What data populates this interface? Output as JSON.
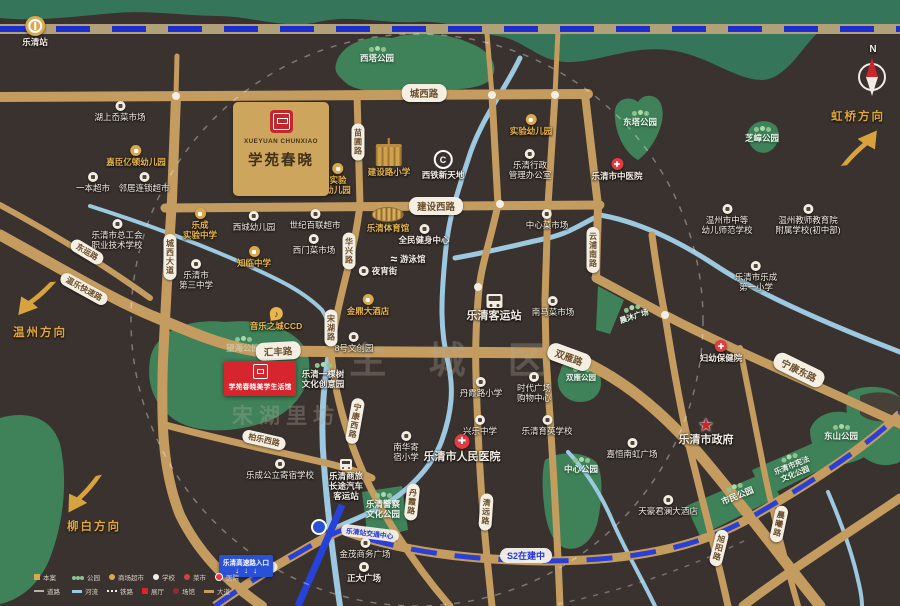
{
  "watermarks": [
    {
      "text": "主 城 区",
      "x": 455,
      "y": 330
    },
    {
      "text": "宋湖里坊",
      "x": 286,
      "y": 400
    }
  ],
  "project": {
    "logo_en": "XUEYUAN CHUNXIAO",
    "logo_cn": "学苑春晓",
    "sales_label": "学苑春晓美学生活馆"
  },
  "compass": {
    "n": "N"
  },
  "labels": {
    "s2": "S2在建中",
    "hub": "乐清站交通中心",
    "highway": "乐清高速路入口",
    "highway_arrows": "↓↓↓"
  },
  "directions": [
    {
      "label": "虹桥方向",
      "x": 858,
      "y": 108
    },
    {
      "label": "温州方向",
      "x": 40,
      "y": 324
    },
    {
      "label": "柳白方向",
      "x": 94,
      "y": 518
    }
  ],
  "road_badges": [
    {
      "label": "城西路",
      "x": 424,
      "y": 93,
      "cls": "lg"
    },
    {
      "label": "建设西路",
      "x": 436,
      "y": 206,
      "cls": "lg"
    },
    {
      "label": "汇丰路",
      "x": 278,
      "y": 351,
      "rot": -3,
      "cls": "lg"
    },
    {
      "label": "双雁路",
      "x": 569,
      "y": 357,
      "rot": 20,
      "cls": "lg"
    },
    {
      "label": "宁康东路",
      "x": 799,
      "y": 370,
      "rot": 26,
      "cls": "lg"
    },
    {
      "label": "温乐快速路",
      "x": 84,
      "y": 289,
      "rot": 29
    },
    {
      "label": "东运路",
      "x": 87,
      "y": 252,
      "rot": 31
    },
    {
      "label": "柏乐西路",
      "x": 264,
      "y": 440,
      "rot": 13
    },
    {
      "label": "城西大道",
      "x": 170,
      "y": 257,
      "cls": "vert"
    },
    {
      "label": "苗圃路",
      "x": 358,
      "y": 142,
      "cls": "vert"
    },
    {
      "label": "华兴路",
      "x": 349,
      "y": 251,
      "cls": "vert"
    },
    {
      "label": "宋湖路",
      "x": 331,
      "y": 328,
      "cls": "vert"
    },
    {
      "label": "宁康西路",
      "x": 355,
      "y": 421,
      "rot": 10,
      "cls": "vert"
    },
    {
      "label": "丹霞路",
      "x": 412,
      "y": 502,
      "rot": 6,
      "cls": "vert"
    },
    {
      "label": "清远路",
      "x": 486,
      "y": 512,
      "rot": 4,
      "cls": "vert"
    },
    {
      "label": "云浦南路",
      "x": 593,
      "y": 250,
      "cls": "vert"
    },
    {
      "label": "旭阳路",
      "x": 719,
      "y": 548,
      "rot": 14,
      "cls": "vert"
    },
    {
      "label": "晨曦路",
      "x": 779,
      "y": 524,
      "rot": 12,
      "cls": "vert"
    }
  ],
  "pois": [
    {
      "x": 35,
      "y": 16,
      "icon": "train",
      "label": "乐清站",
      "cls": "bold"
    },
    {
      "x": 120,
      "y": 101,
      "icon": "w",
      "label": "湖上岙菜市场"
    },
    {
      "x": 136,
      "y": 145,
      "icon": "g",
      "label": "嘉臣亿顿幼儿园",
      "cls": "gold"
    },
    {
      "x": 93,
      "y": 172,
      "icon": "w",
      "label": "一本超市"
    },
    {
      "x": 144,
      "y": 172,
      "icon": "w",
      "label": "邻居连锁超市"
    },
    {
      "x": 377,
      "y": 45,
      "icon": "trees",
      "label": "西塔公园",
      "cls": "park"
    },
    {
      "x": 338,
      "y": 163,
      "icon": "g",
      "label": "实验\n幼儿园",
      "cls": "gold"
    },
    {
      "x": 389,
      "y": 144,
      "icon": "bldg",
      "label": "建设路小学",
      "cls": "gold"
    },
    {
      "x": 443,
      "y": 150,
      "icon": "c",
      "glyph": "C",
      "label": "西铁新天地",
      "cls": "bold"
    },
    {
      "x": 531,
      "y": 114,
      "icon": "g",
      "label": "实验幼儿园",
      "cls": "gold"
    },
    {
      "x": 530,
      "y": 149,
      "icon": "w",
      "label": "乐清行政\n管理办公室"
    },
    {
      "x": 617,
      "y": 158,
      "icon": "h",
      "glyph": "✚",
      "label": "乐清市中医院",
      "cls": "bold"
    },
    {
      "x": 640,
      "y": 109,
      "icon": "trees",
      "label": "东塔公园",
      "cls": "park"
    },
    {
      "x": 762,
      "y": 125,
      "icon": "trees",
      "label": "芝嶂公园",
      "cls": "park"
    },
    {
      "x": 727,
      "y": 204,
      "icon": "w",
      "label": "温州市中等\n幼儿师范学校"
    },
    {
      "x": 808,
      "y": 204,
      "icon": "w",
      "label": "温州教师教育院\n附属学校(初中部)"
    },
    {
      "x": 117,
      "y": 219,
      "icon": "w",
      "label": "乐清市总工会\n职业技术学校"
    },
    {
      "x": 200,
      "y": 208,
      "icon": "g",
      "label": "乐成\n实验中学",
      "cls": "gold"
    },
    {
      "x": 254,
      "y": 211,
      "icon": "w",
      "label": "西城幼儿园"
    },
    {
      "x": 254,
      "y": 246,
      "icon": "g",
      "label": "知临中学",
      "cls": "gold"
    },
    {
      "x": 196,
      "y": 259,
      "icon": "w",
      "label": "乐清市\n第三中学"
    },
    {
      "x": 315,
      "y": 209,
      "icon": "w",
      "label": "世纪百联超市"
    },
    {
      "x": 388,
      "y": 207,
      "icon": "stad",
      "label": "乐清体育馆",
      "cls": "gold"
    },
    {
      "x": 424,
      "y": 224,
      "icon": "w",
      "label": "全民健身中心",
      "cls": "bold"
    },
    {
      "x": 314,
      "y": 234,
      "icon": "w",
      "label": "西门菜市场"
    },
    {
      "x": 408,
      "y": 252,
      "icon": "swim",
      "glyph": "≈",
      "label": "游泳馆",
      "cls": "row bold"
    },
    {
      "x": 378,
      "y": 266,
      "icon": "w",
      "label": "夜宵街",
      "cls": "row bold"
    },
    {
      "x": 547,
      "y": 209,
      "icon": "w",
      "label": "中心菜市场"
    },
    {
      "x": 368,
      "y": 294,
      "icon": "g",
      "label": "金鼎大酒店",
      "cls": "gold"
    },
    {
      "x": 494,
      "y": 294,
      "icon": "bus",
      "label": "乐清客运站",
      "cls": "big"
    },
    {
      "x": 553,
      "y": 296,
      "icon": "w",
      "label": "南马菜市场"
    },
    {
      "x": 756,
      "y": 261,
      "icon": "w",
      "label": "乐清市乐成\n第一小学"
    },
    {
      "x": 276,
      "y": 307,
      "icon": "music",
      "glyph": "♪",
      "label": "音乐之城CCD",
      "cls": "gold"
    },
    {
      "x": 354,
      "y": 332,
      "icon": "w",
      "label": "8号文创园"
    },
    {
      "x": 323,
      "y": 361,
      "icon": "trees",
      "label": "乐清一棵树\n文化创意园",
      "cls": "bold"
    },
    {
      "x": 243,
      "y": 335,
      "icon": "trees",
      "label": "望海公园",
      "cls": "park faint"
    },
    {
      "x": 633,
      "y": 304,
      "icon": "trees",
      "label": "晨沐广场",
      "cls": "park tiny",
      "rot": -18
    },
    {
      "x": 581,
      "y": 365,
      "icon": "trees",
      "label": "双雁公园",
      "cls": "park tiny"
    },
    {
      "x": 406,
      "y": 431,
      "icon": "w",
      "label": "南华寄\n宿小学"
    },
    {
      "x": 462,
      "y": 434,
      "icon": "h",
      "glyph": "✚",
      "label": "乐清市人民医院",
      "cls": "big"
    },
    {
      "x": 480,
      "y": 415,
      "icon": "w",
      "label": "兴乐中学"
    },
    {
      "x": 547,
      "y": 415,
      "icon": "w",
      "label": "乐清育英学校"
    },
    {
      "x": 534,
      "y": 372,
      "icon": "w",
      "label": "时代广场\n购物中心"
    },
    {
      "x": 481,
      "y": 377,
      "icon": "w",
      "label": "丹霞路小学"
    },
    {
      "x": 346,
      "y": 459,
      "icon": "busS",
      "label": "乐清商旅\n长途汽车\n客运站",
      "cls": "bold"
    },
    {
      "x": 280,
      "y": 459,
      "icon": "w",
      "label": "乐成公立寄宿学校"
    },
    {
      "x": 383,
      "y": 491,
      "icon": "trees",
      "label": "乐清警察\n文化公园",
      "cls": "park"
    },
    {
      "x": 365,
      "y": 538,
      "icon": "w",
      "label": "金茂商务广场"
    },
    {
      "x": 364,
      "y": 562,
      "icon": "w",
      "label": "正大广场",
      "cls": "bold"
    },
    {
      "x": 581,
      "y": 456,
      "icon": "trees",
      "label": "中心公园",
      "cls": "park"
    },
    {
      "x": 632,
      "y": 438,
      "icon": "w",
      "label": "嘉恒南虹广场"
    },
    {
      "x": 706,
      "y": 418,
      "icon": "star",
      "glyph": "★",
      "label": "乐清市政府",
      "cls": "big"
    },
    {
      "x": 668,
      "y": 495,
      "icon": "w",
      "label": "天豪君澜大酒店"
    },
    {
      "x": 736,
      "y": 483,
      "icon": "trees",
      "label": "市民公园",
      "cls": "park",
      "rot": -22
    },
    {
      "x": 792,
      "y": 453,
      "icon": "trees",
      "label": "乐清市宪法\n文化公园",
      "cls": "park tiny",
      "rot": -22
    },
    {
      "x": 841,
      "y": 423,
      "icon": "trees",
      "label": "东山公园",
      "cls": "park"
    },
    {
      "x": 721,
      "y": 340,
      "icon": "h",
      "glyph": "✚",
      "label": "妇幼保健院",
      "cls": "bold"
    }
  ],
  "legend": {
    "primary": [
      {
        "icon": "sq",
        "label": "本案"
      },
      {
        "icon": "ln",
        "label": "道路"
      }
    ],
    "row1": [
      {
        "icon": "tr",
        "label": "公园"
      },
      {
        "icon": "cg",
        "label": "商场超市"
      },
      {
        "icon": "cw",
        "label": "学校"
      },
      {
        "icon": "cr",
        "label": "菜市"
      },
      {
        "icon": "ch",
        "label": "医院"
      }
    ],
    "row2": [
      {
        "icon": "br",
        "label": "河流"
      },
      {
        "icon": "rl",
        "label": "铁路"
      },
      {
        "icon": "sr",
        "label": "展厅"
      },
      {
        "icon": "cd",
        "label": "场馆"
      },
      {
        "icon": "bg",
        "label": "大道"
      }
    ]
  }
}
